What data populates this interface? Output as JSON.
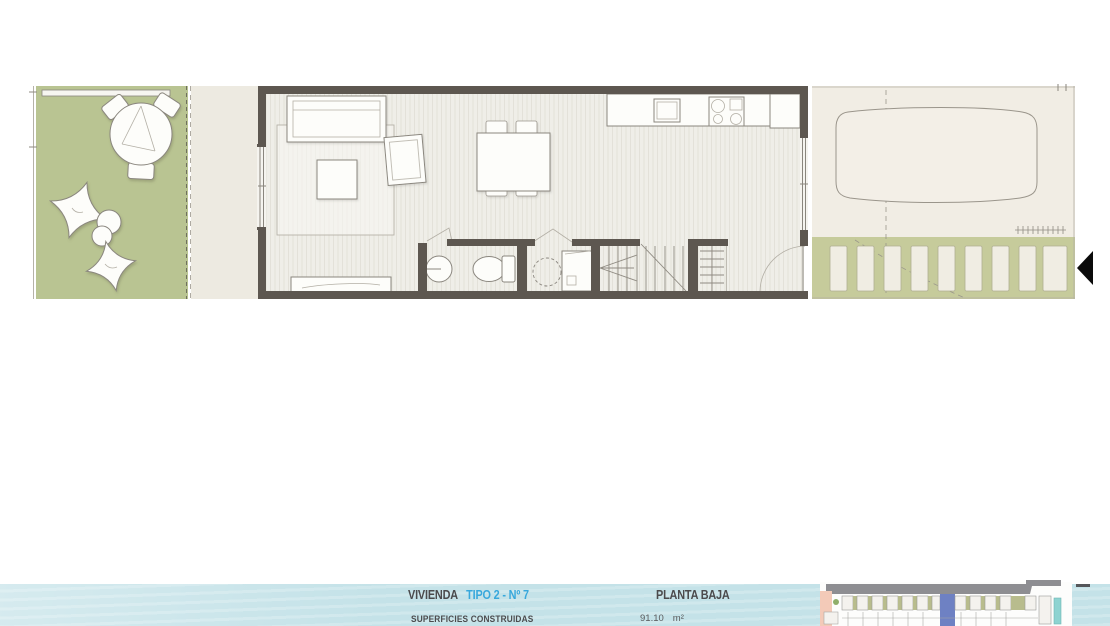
{
  "footer": {
    "dwelling_label": "VIVIENDA",
    "dwelling_type": "TIPO 2 - Nº 7",
    "floor_label": "PLANTA BAJA",
    "surfaces_label": "SUPERFICIES CONSTRUIDAS",
    "surface_value": "91.10",
    "surface_unit": "m²"
  },
  "colors": {
    "garden_green": "#b9c492",
    "paver_green": "#c6cb9b",
    "terrace_beige": "#edeae1",
    "wall": "#5d5750",
    "parking_cream": "#f1ede4",
    "floor_base": "#efeee8",
    "floor_stripe": "#e3e1d9",
    "water_blue": "#c4e2e8",
    "title_dark": "#4b4b4d",
    "title_blue": "#38a8dc",
    "minimap_road": "#8e8e92",
    "minimap_salmon": "#f3cab8",
    "minimap_olive": "#b8bc8d",
    "minimap_highlight": "#6e81c3",
    "minimap_teal": "#8ed3d1",
    "arrow_black": "#0b0b0b"
  }
}
